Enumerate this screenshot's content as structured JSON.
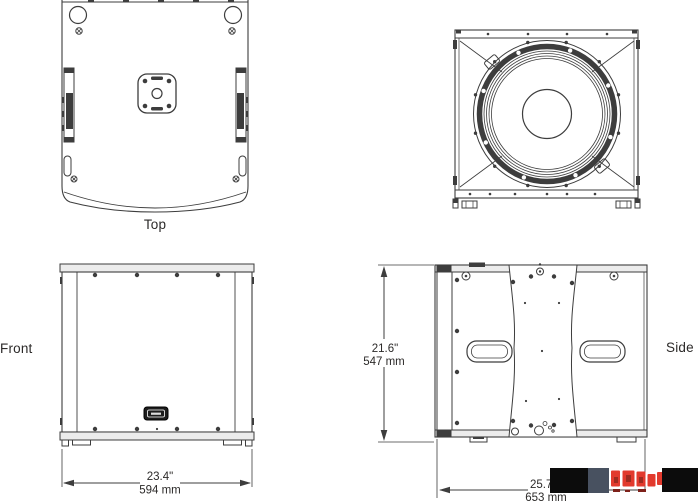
{
  "views": {
    "top": {
      "label": "Top"
    },
    "bottom": {
      "label": ""
    },
    "front": {
      "label": "Front",
      "width_inches": "23.4\"",
      "width_mm": "594 mm"
    },
    "side": {
      "label": "Side",
      "height_inches": "21.6\"",
      "height_mm": "547 mm",
      "depth_inches": "25.7\"",
      "depth_mm": "653 mm"
    }
  },
  "colors": {
    "line": "#3d3d3d",
    "text": "#2c2a29",
    "panel_fill": "#ececec",
    "logo_black": "#0c0c0c",
    "logo_slate": "#485160",
    "logo_red": "#e23a2d",
    "logo_red_dark": "#9e2b20",
    "logo_red_deep": "#7e211a"
  }
}
